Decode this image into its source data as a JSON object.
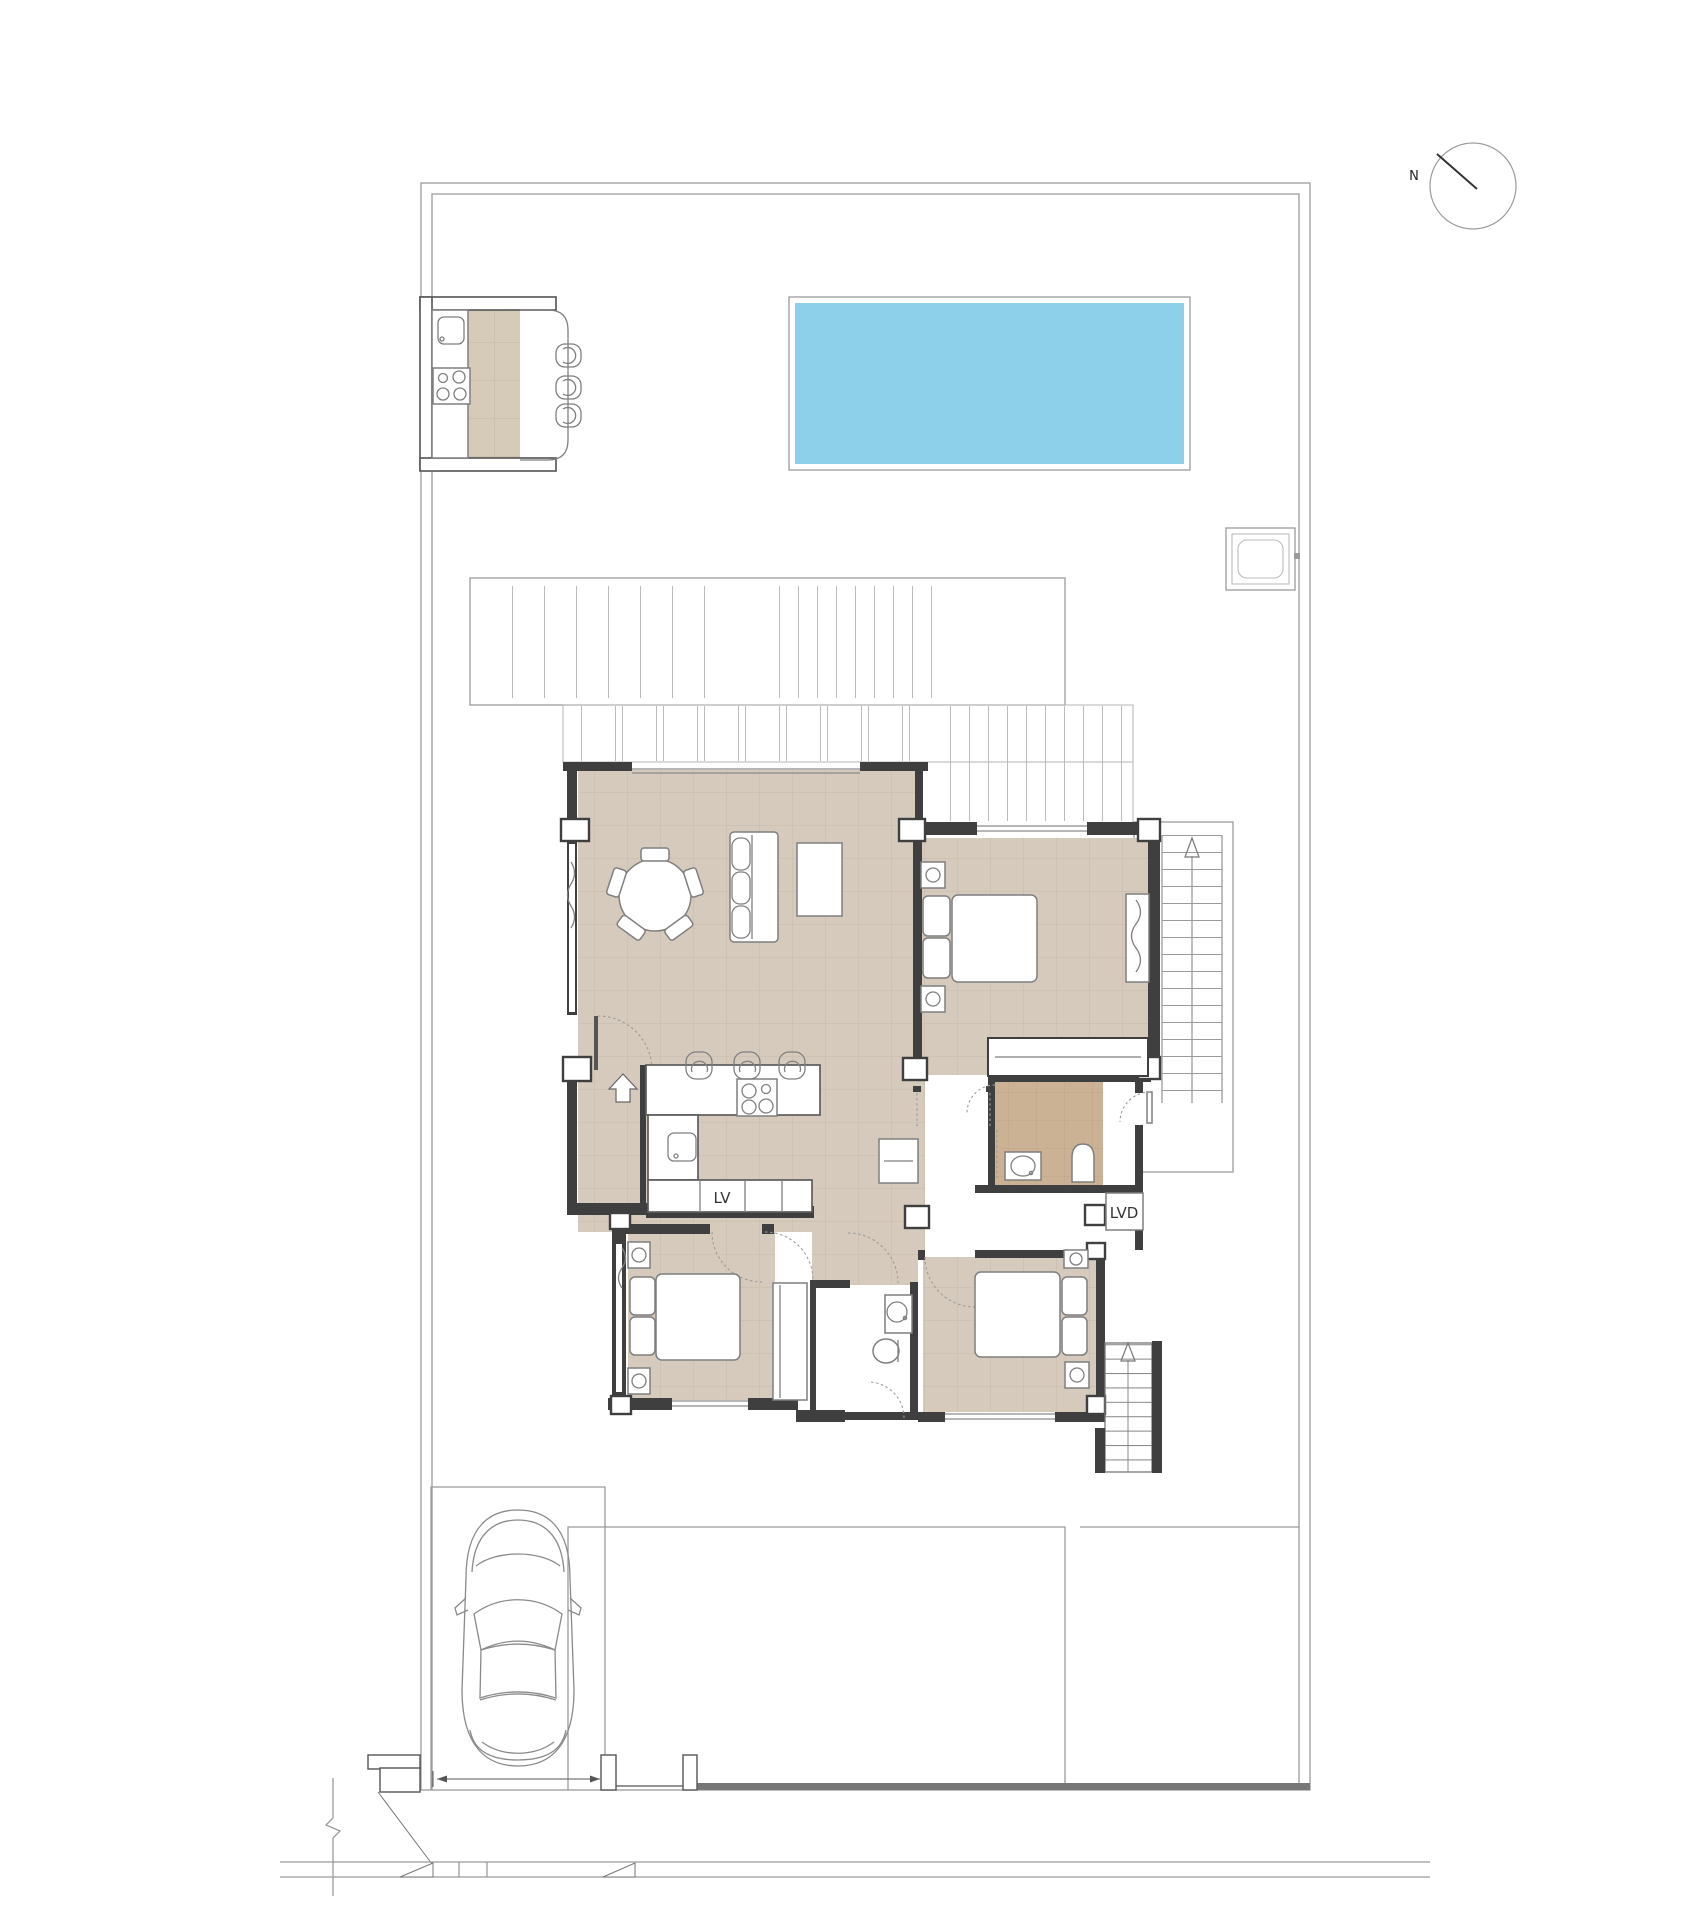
{
  "plan": {
    "kind": "residential site / floor plan drawing",
    "labels": {
      "dishwasher": "LV",
      "washer": "LVD",
      "north": "N"
    },
    "icons": [
      "north-arrow-icon",
      "entrance-arrow-icon",
      "stairs-up-arrow-icon"
    ],
    "colors": {
      "page_bg": "#ffffff",
      "pool": "#8dd0ea",
      "floor": "#d5cabc",
      "floor_grid": "#c7baa9",
      "bath_floor": "#ccb295",
      "bath_grid": "#bfa584",
      "counter_strip": "#d6cab8",
      "counter_grid": "#c6b9a5",
      "wall": "#3f3f3f",
      "line": "#9b9b9b",
      "line_light": "#bcbcbc",
      "furniture": "#7f7f7f"
    }
  }
}
